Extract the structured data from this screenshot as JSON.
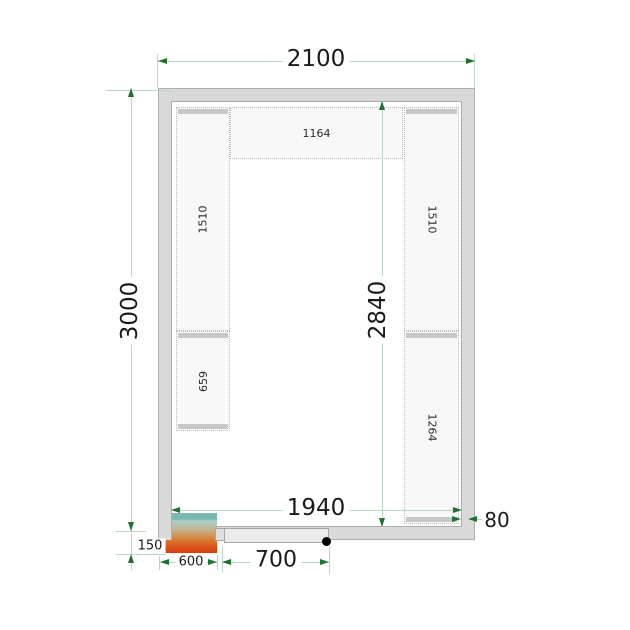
{
  "dimensions": {
    "outer_width": "2100",
    "outer_depth": "3000",
    "inner_width": "1940",
    "inner_depth": "2840",
    "wall_thickness": "80",
    "unit_width": "600",
    "unit_protrusion": "150",
    "door_width": "700"
  },
  "shelves": {
    "top": "1164",
    "left_upper": "1510",
    "left_lower": "659",
    "right_upper": "1510",
    "right_lower": "1264"
  },
  "colors": {
    "dimension_line": "#bcd8c4",
    "dimension_arrow": "#1e722e",
    "wall_fill": "#d9d9d9",
    "shelf_fill": "#f8f8f8",
    "shelf_bar": "#c8c8c8",
    "unit_teal": "#7ab9b1",
    "unit_orange": "#d63f10",
    "door_fill": "#ebebeb"
  }
}
